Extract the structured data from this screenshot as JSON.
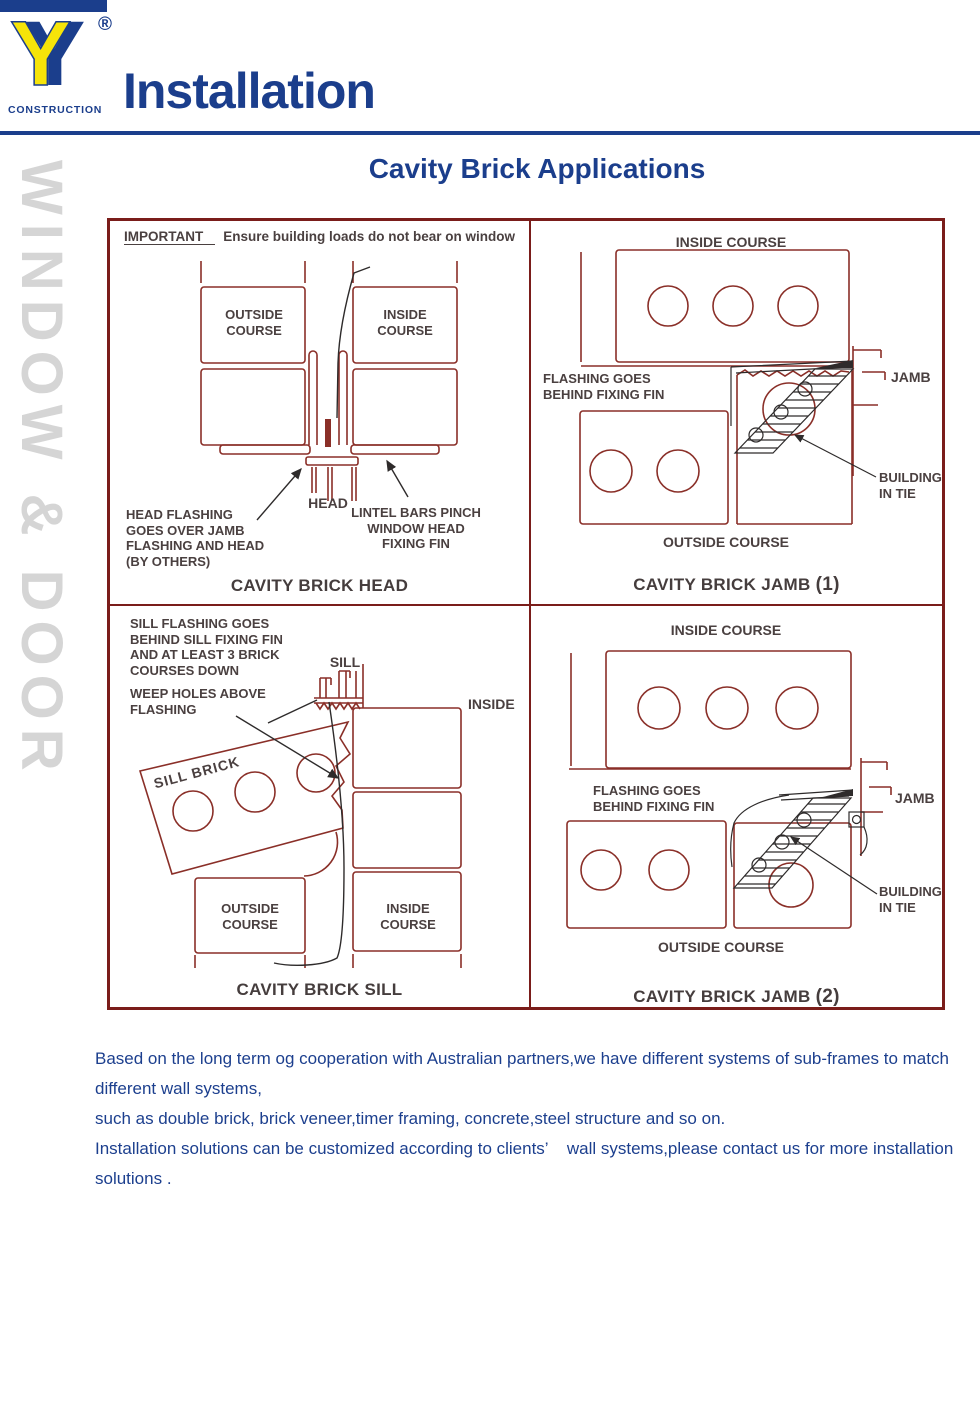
{
  "header": {
    "logo_letter": "Y",
    "registered_mark": "®",
    "logo_subtitle": "CONSTRUCTION",
    "page_title": "Installation"
  },
  "watermark": "WINDOW & DOOR",
  "section_title": "Cavity Brick Applications",
  "panels": {
    "head": {
      "important_label": "IMPORTANT",
      "important_text": "Ensure building loads do not bear on window",
      "outside_course": "OUTSIDE\nCOURSE",
      "inside_course": "INSIDE\nCOURSE",
      "head_label": "HEAD",
      "note_left": "HEAD FLASHING\nGOES OVER JAMB\nFLASHING AND HEAD\n(BY OTHERS)",
      "note_right": "LINTEL BARS PINCH\nWINDOW HEAD\nFIXING FIN",
      "caption": "CAVITY BRICK HEAD"
    },
    "jamb1": {
      "inside_course": "INSIDE COURSE",
      "flashing_note": "FLASHING GOES\nBEHIND FIXING FIN",
      "jamb_label": "JAMB",
      "tie_note": "BUILDING\nIN TIE",
      "outside_course": "OUTSIDE COURSE",
      "caption": "CAVITY BRICK JAMB",
      "caption_number": "(1)"
    },
    "sill": {
      "flashing_note": "SILL FLASHING GOES\nBEHIND SILL FIXING FIN\nAND AT LEAST 3 BRICK\nCOURSES DOWN",
      "weep_note": "WEEP HOLES ABOVE\nFLASHING",
      "sill_label": "SILL",
      "inside_label": "INSIDE",
      "sill_brick_label": "SILL BRICK",
      "outside_course": "OUTSIDE\nCOURSE",
      "inside_course": "INSIDE\nCOURSE",
      "caption": "CAVITY BRICK SILL"
    },
    "jamb2": {
      "inside_course": "INSIDE COURSE",
      "flashing_note": "FLASHING GOES\nBEHIND FIXING FIN",
      "jamb_label": "JAMB",
      "tie_note": "BUILDING\nIN TIE",
      "outside_course": "OUTSIDE COURSE",
      "caption": "CAVITY BRICK JAMB",
      "caption_number": "(2)"
    }
  },
  "footer": {
    "lines": [
      "Based on the long term og cooperation with Australian partners,we have different systems of sub-frames to match",
      "different wall systems,",
      "such as double brick, brick veneer,timer framing, concrete,steel structure and so on.",
      "Installation solutions can be customized according to clients’    wall systems,please contact us for more installation",
      "solutions ."
    ]
  },
  "colors": {
    "accent_blue": "#1b3e8c",
    "logo_yellow": "#f6e409",
    "diagram_line_maroon": "#8a2f28",
    "grid_border_maroon": "#7a1d1a",
    "label_gray": "#4a4040",
    "watermark_gray": "#d5d5d5"
  }
}
